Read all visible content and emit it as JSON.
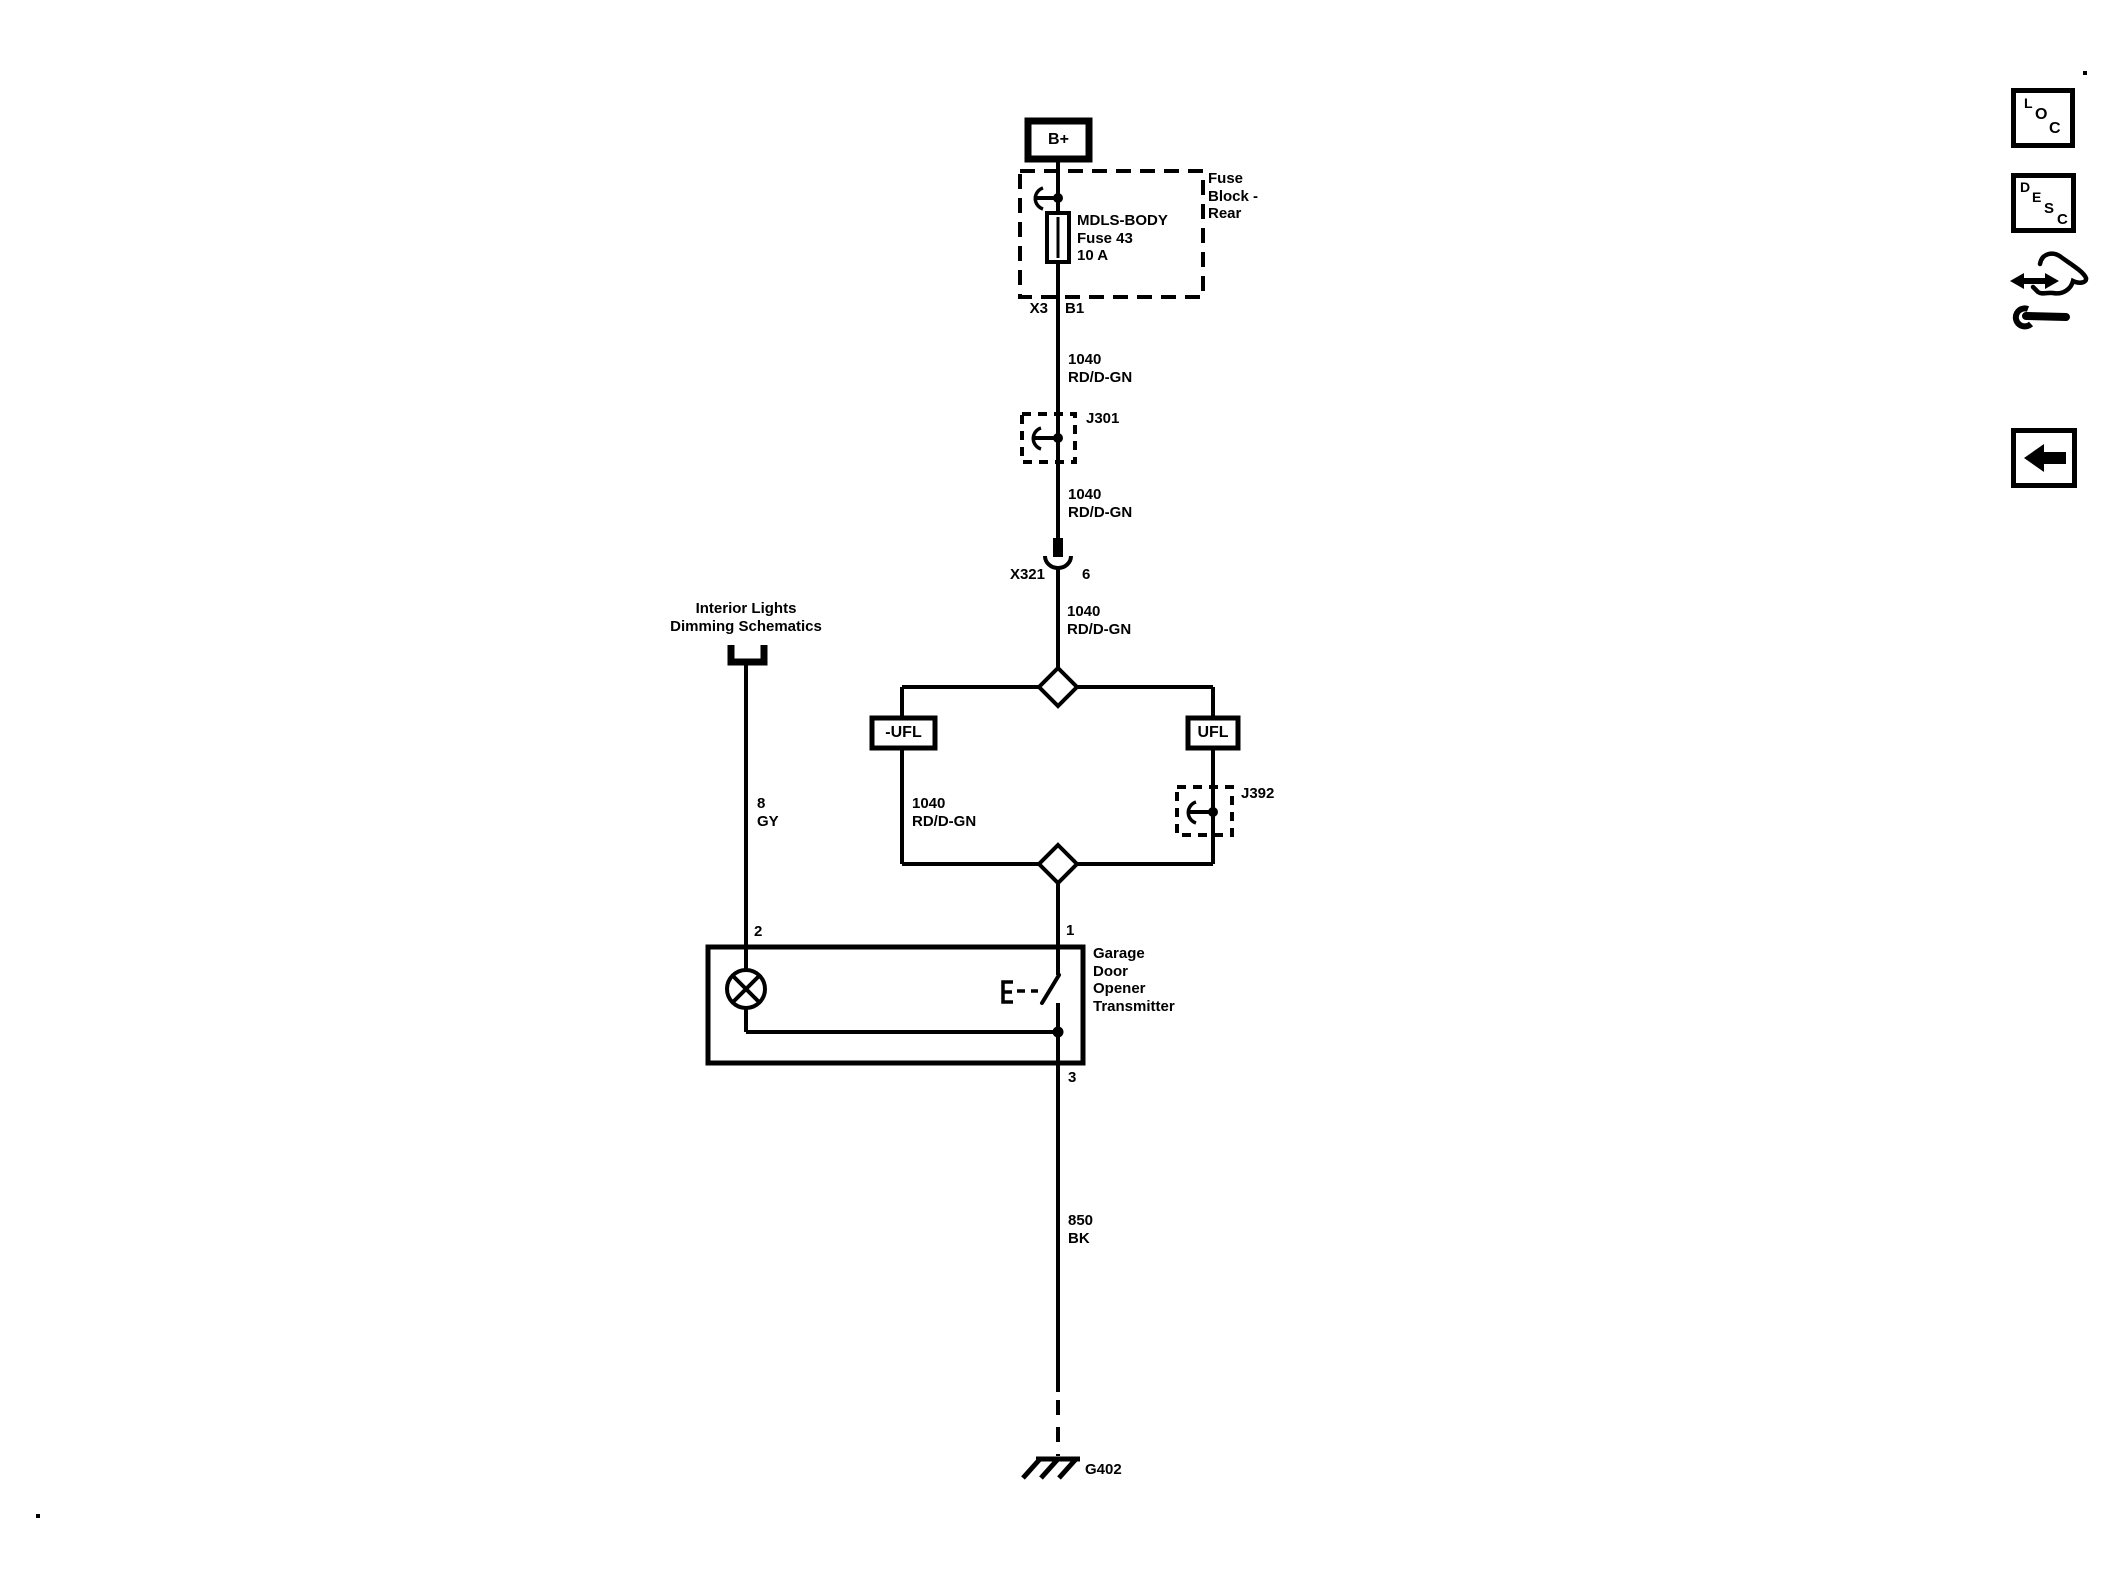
{
  "colors": {
    "ink": "#000000",
    "paper": "#ffffff"
  },
  "schematic": {
    "battery": {
      "label": "B+"
    },
    "fuse_block": {
      "name": [
        "Fuse",
        "Block -",
        "Rear"
      ],
      "fuse": [
        "MDLS-BODY",
        "Fuse 43",
        "10 A"
      ],
      "connector": "X3",
      "pin": "B1"
    },
    "wire_fuse_to_j301": {
      "circuit": "1040",
      "color": "RD/D-GN"
    },
    "splice_j301": {
      "label": "J301"
    },
    "wire_j301_to_x321": {
      "circuit": "1040",
      "color": "RD/D-GN"
    },
    "connector_x321": {
      "name": "X321",
      "pin": "6"
    },
    "wire_x321_to_split": {
      "circuit": "1040",
      "color": "RD/D-GN"
    },
    "offpage_ref": {
      "line1": "Interior Lights",
      "line2": "Dimming Schematics"
    },
    "wire_dimming": {
      "circuit": "8",
      "color": "GY"
    },
    "option_left": {
      "label": "-UFL"
    },
    "option_right": {
      "label": "UFL"
    },
    "splice_j392": {
      "label": "J392"
    },
    "wire_left_branch": {
      "circuit": "1040",
      "color": "RD/D-GN"
    },
    "transmitter": {
      "pin_lamp": "2",
      "pin_power": "1",
      "pin_ground": "3",
      "name": [
        "Garage",
        "Door",
        "Opener",
        "Transmitter"
      ]
    },
    "wire_ground": {
      "circuit": "850",
      "color": "BK"
    },
    "ground": {
      "label": "G402"
    }
  },
  "toolbar": {
    "loc": [
      "L",
      "O",
      "C"
    ],
    "desc": [
      "D",
      "E",
      "S",
      "C"
    ]
  }
}
